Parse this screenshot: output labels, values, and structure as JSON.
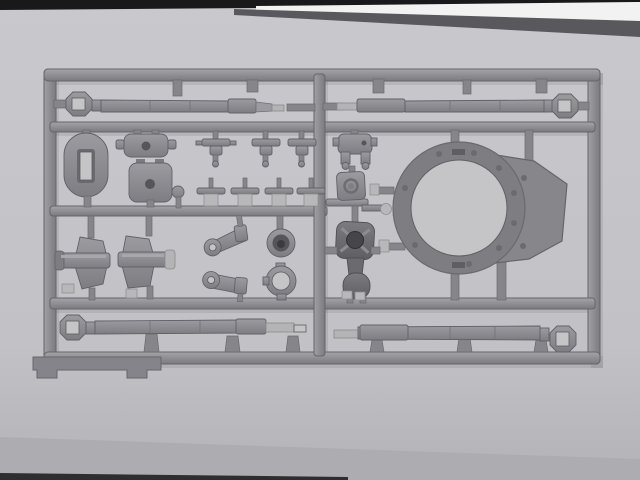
{
  "scene": {
    "type": "photograph",
    "subject": "gray injection-molded plastic model kit sprue (parts tree) with tank parts",
    "setting": "lying on a light gray paper background, dark table edge visible at top and bottom"
  },
  "colors": {
    "background": "#c3c3c7",
    "background_top": "#c9c9cd",
    "background_bottom": "#adadb1",
    "band_black": "#19191b",
    "band_white": "#f2f2f3",
    "band_gray": "#59595d",
    "plastic": "#8b8b8f",
    "plastic_light": "#b8b8bb",
    "plastic_dark": "#68686c",
    "part_dark": "#6e6e72",
    "hole_through": "#c5c5c8",
    "bottom_edge_line": "#2e2e30"
  },
  "parts": {
    "frame": "rectangular sprue runner frame with middle vertical runner and three inner horizontal runners",
    "barrel_top_left": "long gun barrel, muzzle brake at left end",
    "barrel_top_right": "long gun barrel, muzzle brake at right end",
    "barrel_bottom_left": "long gun barrel, muzzle brake at left end",
    "barrel_bottom_right": "long gun barrel, muzzle brake at right end",
    "oval_slotted_part": "oval plate with rectangular slot",
    "hatch_plate": "rounded plate with center hole and side tabs",
    "mount_plate": "rounded square plate with center hole",
    "pin_part": "small round-head pin",
    "small_brackets_row1": "three small T-shaped brackets",
    "small_brackets_row2": "four small brackets with pins and blocks",
    "cradle_bracket": "small yoke bracket with two legs",
    "pivot_plate": "square pivot plate with ring hole",
    "disc_bracket": "small bar with shiny disc",
    "trunnion_left": "trunnion mount, axle cap to left",
    "trunnion_right": "trunnion mount, shiny axle cap to right",
    "lever_upper": "crank lever with round boss and hole",
    "lever_lower": "crank lever with round boss and hole",
    "cup_part": "round cup with deep bore",
    "clamp_ring": "ring with lugs, open center",
    "gun_cradle": "dark gun cradle: cross-ribbed plate, cylindrical neck, round housing",
    "turret_ring": "large turret top plate with big circular ring opening and rivets",
    "sprue_tab": "flat tab with two feet at bottom left of frame"
  }
}
